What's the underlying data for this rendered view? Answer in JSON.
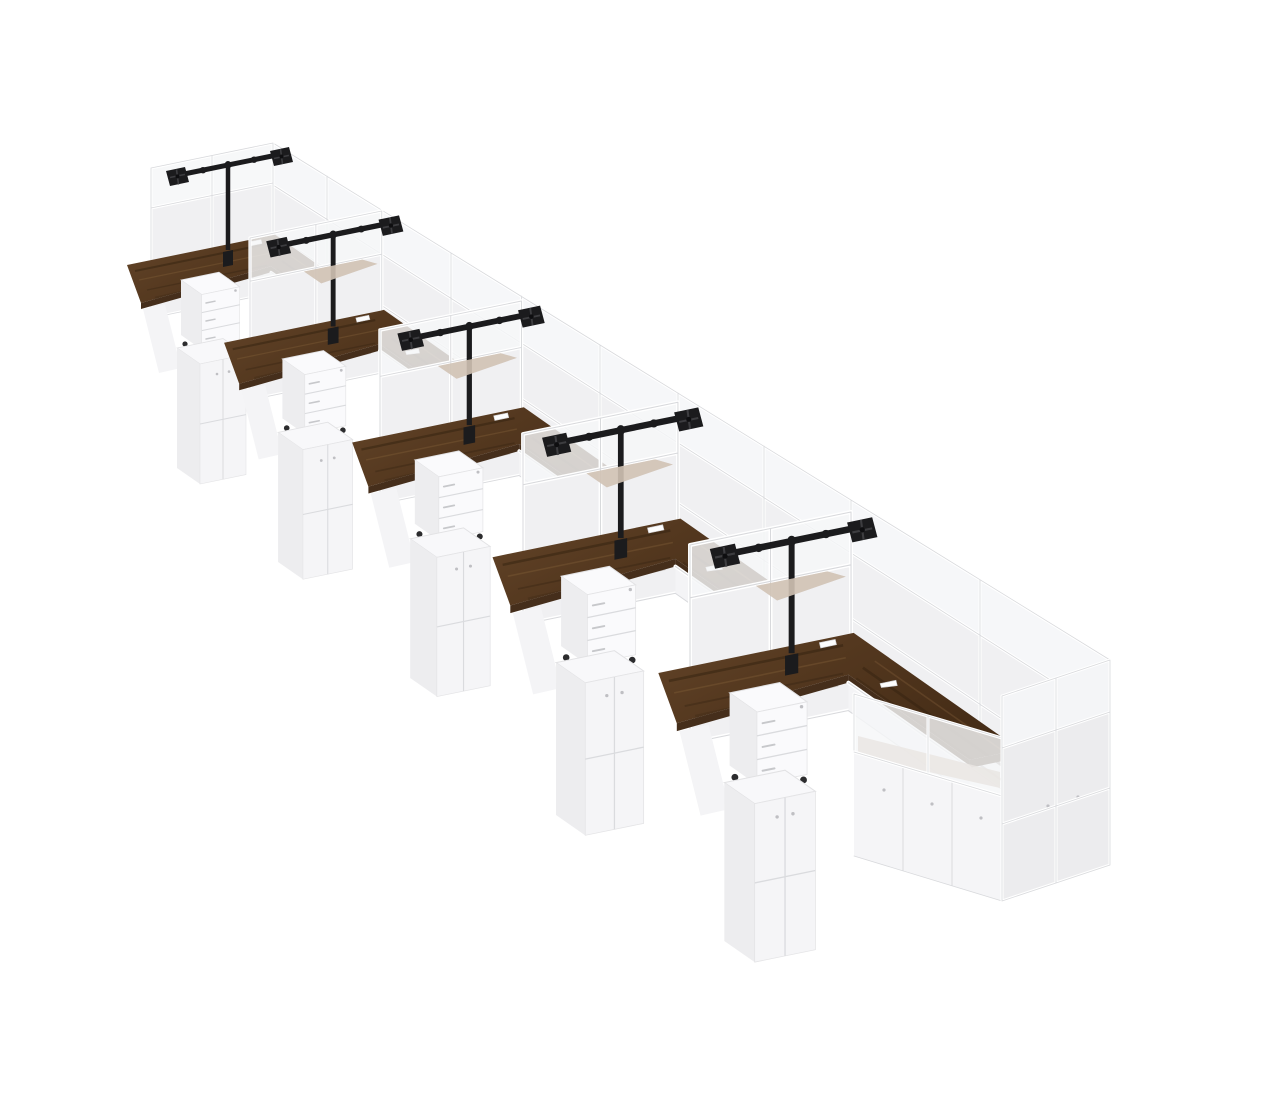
{
  "meta": {
    "aria_label": "3D render of five white office cubicle workstations in a diagonal row, each with a dark walnut L-shaped desk, black dual monitor arm, white three-drawer mobile pedestal, white storage cabinets, and white-framed glass-top partition panels"
  },
  "colors": {
    "background": "#ffffff",
    "wall-solid": "#f0f0f2",
    "wall-solid-dark": "#ececee",
    "wall-glass": "#f5f6f8",
    "frame": "#ffffff",
    "frame-line": "#d8d9dc",
    "walnut": "#54381f",
    "walnut-dark": "#3c2715",
    "walnut-light": "#6f4e2e",
    "walnut-edge": "#452e1b",
    "walnut-haze": "#b59e87",
    "arm-black": "#1b1b1d",
    "ped-front": "#fafafc",
    "ped-side": "#ededef",
    "ped-line": "#dadbde",
    "cab-front": "#f5f5f7",
    "cab-side": "#e9e9eb",
    "caster": "#2c2c2e",
    "lock": "#bfbfc3"
  },
  "scene": {
    "workstation_count": 5,
    "desk": {
      "shape": "L-shaped",
      "finish": "dark walnut",
      "grommets_per_desk": 2
    },
    "monitor_arm": {
      "type": "dual VESA pole mount",
      "color": "black",
      "plates": 2
    },
    "pedestal": {
      "drawers": 3,
      "casters": true,
      "color": "white"
    },
    "storage_cabinet": {
      "doors": 2,
      "color": "white"
    },
    "partitions": {
      "style": "white frame, solid lower panels, glass top band"
    }
  }
}
